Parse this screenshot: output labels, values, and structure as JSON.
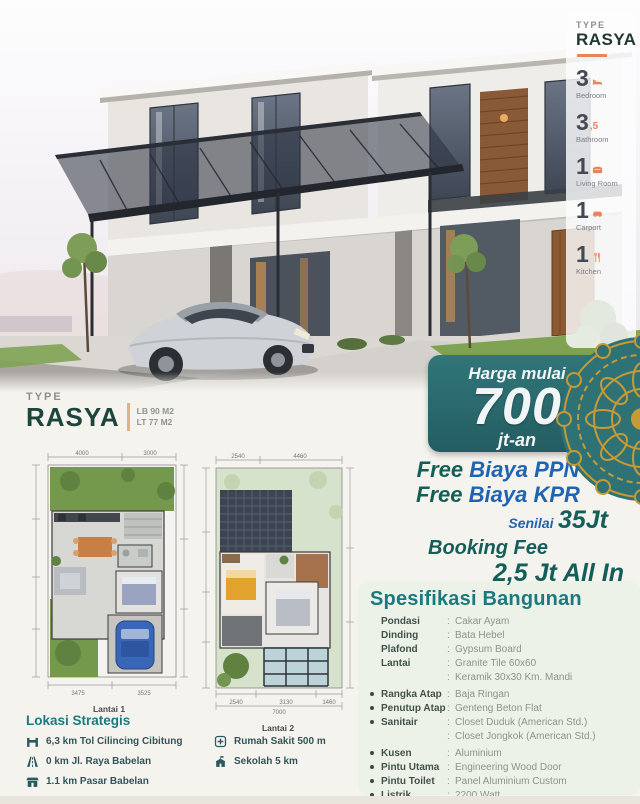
{
  "colors": {
    "teal_ribbon": "#2a6e72",
    "dark_green_text": "#1e453c",
    "orange_accent": "#e8845c",
    "blue_text": "#1f64b0",
    "gold_ornament": "#c79a36",
    "heading_teal": "#1b7a80"
  },
  "sidebar": {
    "type_label": "TYPE",
    "type_name": "RASYA",
    "features": [
      {
        "value": "3",
        "label": "Bedroom",
        "icon": "bed-icon"
      },
      {
        "value": "3",
        "suffix": ",5",
        "label": "Bathroom",
        "icon": "bath-icon"
      },
      {
        "value": "1",
        "label": "Living Room",
        "icon": "sofa-icon"
      },
      {
        "value": "1",
        "label": "Carport",
        "icon": "car-icon"
      },
      {
        "value": "1",
        "label": "Kitchen",
        "icon": "kitchen-icon"
      }
    ]
  },
  "price": {
    "prefix": "Harga mulai",
    "amount": "700",
    "suffix": "jt-an"
  },
  "type_block": {
    "label": "TYPE",
    "name": "RASYA",
    "area_building": "LB 90 M2",
    "area_land": "LT 77 M2"
  },
  "floorplans": {
    "plan1": {
      "label": "Lantai 1",
      "dim_top": [
        "4000",
        "3000"
      ],
      "dim_bottom": [
        "3475",
        "3525"
      ]
    },
    "plan2": {
      "label": "Lantai 2",
      "dim_top": [
        "2540",
        "4460"
      ],
      "dim_bottom": [
        "2540",
        "3130",
        "1460"
      ],
      "dim_total": "7000"
    }
  },
  "promo": {
    "line1": {
      "free": "Free",
      "rest": "Biaya PPN"
    },
    "line2": {
      "free": "Free",
      "rest": "Biaya KPR"
    },
    "line3": {
      "senilai": "Senilai",
      "amount": "35Jt"
    },
    "line4": "Booking Fee",
    "line5": "2,5 Jt All In"
  },
  "specs": {
    "title": "Spesifikasi Bangunan",
    "separator": ":",
    "items": [
      {
        "label": "Pondasi",
        "value": "Cakar Ayam",
        "bullet": false
      },
      {
        "label": "Dinding",
        "value": "Bata Hebel",
        "bullet": false
      },
      {
        "label": "Plafond",
        "value": "Gypsum Board",
        "bullet": false
      },
      {
        "label": "Lantai",
        "value": "Granite Tile 60x60",
        "value2": "Keramik 30x30 Km. Mandi",
        "bullet": false
      },
      {
        "label": "Rangka Atap",
        "value": "Baja Ringan",
        "bullet": true
      },
      {
        "label": "Penutup Atap",
        "value": "Genteng Beton Flat",
        "bullet": true
      },
      {
        "label": "Sanitair",
        "value": "Closet Duduk (American Std.)",
        "value2": "Closet Jongkok (American Std.)",
        "bullet": true
      },
      {
        "label": "Kusen",
        "value": "Aluminium",
        "bullet": true
      },
      {
        "label": "Pintu Utama",
        "value": "Engineering Wood Door",
        "bullet": true
      },
      {
        "label": "Pintu Toilet",
        "value": "Panel Aluminium Custom",
        "bullet": true
      },
      {
        "label": "Listrik",
        "value": "2200 Watt",
        "bullet": true
      }
    ]
  },
  "location": {
    "title": "Lokasi Strategis",
    "col1": [
      {
        "icon": "toll-gate-icon",
        "text": "6,3 km Tol Cilincing Cibitung"
      },
      {
        "icon": "road-icon",
        "text": "0 km Jl. Raya Babelan"
      },
      {
        "icon": "market-icon",
        "text": "1.1 km Pasar Babelan"
      }
    ],
    "col2": [
      {
        "icon": "hospital-icon",
        "text": "Rumah Sakit 500 m"
      },
      {
        "icon": "school-icon",
        "text": "Sekolah 5 km"
      }
    ]
  }
}
